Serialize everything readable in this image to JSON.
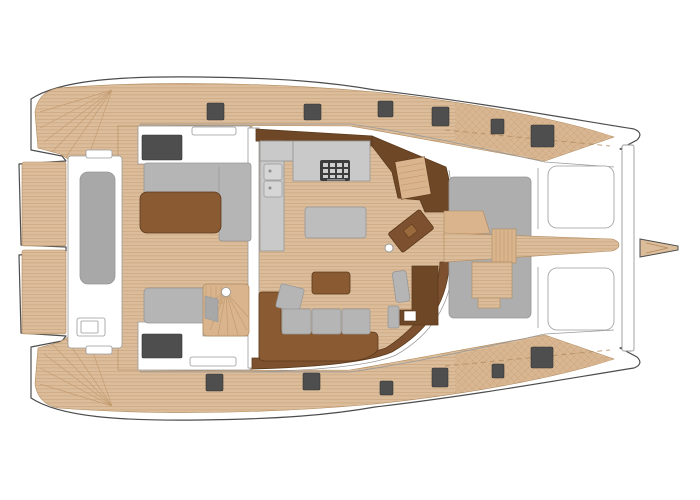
{
  "diagram": {
    "kind": "catamaran-deck-plan",
    "orientation": "bow-right",
    "view": "top-down",
    "regions": [
      "swim-platform-port",
      "swim-platform-starboard",
      "transom-steps-port",
      "transom-steps-starboard",
      "aft-tender-platform",
      "aft-cockpit",
      "cockpit-sofa",
      "cockpit-table",
      "cockpit-sunbed",
      "spiral-staircase",
      "saloon",
      "galley-counter",
      "galley-sinks",
      "stove",
      "galley-island",
      "saloon-sofa",
      "coffee-table",
      "helm-station",
      "nav-station",
      "foredeck-sunpad",
      "foredeck-walkway",
      "mast-step",
      "trampoline-port",
      "trampoline-starboard",
      "bow-crossbeam",
      "bowsprit",
      "deck-hatches",
      "port-side-deck",
      "starboard-side-deck"
    ]
  },
  "colors": {
    "white": "#ffffff",
    "hull_outline": "#4d4d4d",
    "line_soft": "#9a9a9a",
    "teak": "#dcbd9b",
    "teak_line": "#c49c72",
    "teak_edge": "#b08a5e",
    "teak_step": "#d9b48d",
    "weave": "#d8b691",
    "gray_pad": "#a8a8a8",
    "gray_sofa": "#b5b5b5",
    "gray_counter": "#c9c9c9",
    "gray_island": "#bdbdbd",
    "gray_sunpad": "#aeaeae",
    "gray_stroke": "#979797",
    "dark_hatch": "#4e4e4e",
    "stove": "#3d3d3d",
    "brown_mid": "#8a5a32",
    "brown_band": "#7d5130",
    "brown_dark": "#6e4726",
    "brown_deep": "#5c3a1c"
  },
  "deck_hatches": {
    "port_deck": [
      [
        207,
        103,
        17,
        17
      ],
      [
        304,
        104,
        17,
        16
      ],
      [
        378,
        101,
        15,
        16
      ],
      [
        432,
        107,
        17,
        19
      ],
      [
        491,
        119,
        13,
        15
      ],
      [
        531,
        125,
        23,
        22
      ]
    ],
    "starboard_deck": [
      [
        206,
        374,
        17,
        17
      ],
      [
        303,
        373,
        17,
        17
      ],
      [
        380,
        381,
        13,
        14
      ],
      [
        432,
        368,
        16,
        19
      ],
      [
        492,
        364,
        12,
        14
      ],
      [
        531,
        347,
        22,
        21
      ]
    ],
    "cabin_tops": [
      [
        142,
        135,
        40,
        25
      ],
      [
        142,
        334,
        40,
        24
      ]
    ]
  },
  "counts": {
    "deck_hatches_total": 14,
    "trampoline_panels": 2,
    "saloon_cushions": 4
  }
}
